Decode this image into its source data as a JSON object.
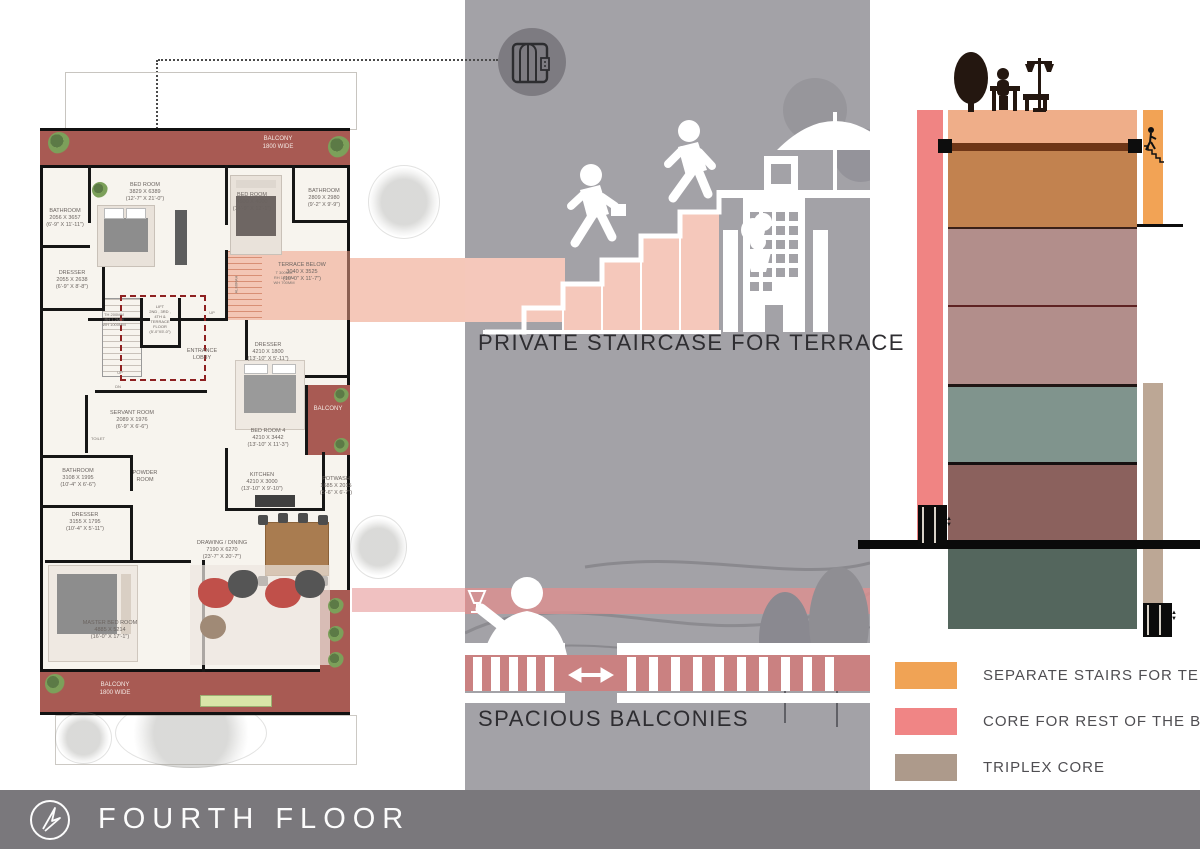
{
  "footer": {
    "title": "FOURTH FLOOR",
    "logo": "compass-arrow-icon"
  },
  "captions": {
    "staircase": "PRIVATE STAIRCASE FOR TERRACE",
    "balconies": "SPACIOUS BALCONIES"
  },
  "legend": {
    "items": [
      {
        "label": "SEPARATE STAIRS FOR TERRACE",
        "color": "#f0a355"
      },
      {
        "label": "CORE FOR REST OF THE BUILDING",
        "color": "#f08585"
      },
      {
        "label": "TRIPLEX CORE",
        "color": "#ad9a8b"
      }
    ]
  },
  "section": {
    "floors": [
      {
        "color": "#efae89",
        "h": 33
      },
      {
        "color": "#6f3617",
        "h": 8
      },
      {
        "color": "#c2824f",
        "h": 76
      },
      {
        "color": "#3a2018",
        "h": 2
      },
      {
        "color": "#b28e8b",
        "h": 76
      },
      {
        "color": "#5e2222",
        "h": 2
      },
      {
        "color": "#b28e8b",
        "h": 77
      },
      {
        "color": "#201614",
        "h": 3
      },
      {
        "color": "#80948d",
        "h": 75
      },
      {
        "color": "#161010",
        "h": 3
      },
      {
        "color": "#8b615d",
        "h": 76
      }
    ],
    "core_color": "#f08483",
    "stair_color": "#f2a355",
    "triplex_color": "#bca795"
  },
  "plan": {
    "rooms": [
      {
        "lines": [
          "BED ROOM",
          "3829 X 6389",
          "(12'-7\" X 21'-0\")"
        ],
        "x": 105,
        "y": 112
      },
      {
        "lines": [
          "BED ROOM",
          "4500 X 4000",
          "(14'-9\" X 12'-1\")"
        ],
        "x": 212,
        "y": 122
      },
      {
        "lines": [
          "BATHROOM",
          "2809 X 2980",
          "(9'-2\" X 9'-9\")"
        ],
        "x": 284,
        "y": 118
      },
      {
        "lines": [
          "BATHROOM",
          "2056 X 3657",
          "(6'-9\" X 11'-11\")"
        ],
        "x": 25,
        "y": 138
      },
      {
        "lines": [
          "DRESSER",
          "2055 X 2638",
          "(6'-9\" X 8'-8\")"
        ],
        "x": 32,
        "y": 200
      },
      {
        "lines": [
          "TERRACE BELOW",
          "3040 X 3525",
          "(10'-0\" X 11'-7\")"
        ],
        "x": 262,
        "y": 192
      },
      {
        "lines": [
          "LIFT",
          "2ND , 3RD ,",
          "4TH &",
          "TERRACE",
          "FLOOR",
          "(5'-0\"X5'-0\")"
        ],
        "x": 120,
        "y": 234,
        "size": 4
      },
      {
        "lines": [
          "ENTRANCE",
          "LOBBY"
        ],
        "x": 162,
        "y": 278
      },
      {
        "lines": [
          "DRESSER",
          "4210 X 1800",
          "(13'-10\" X 5'-11\")"
        ],
        "x": 228,
        "y": 272
      },
      {
        "lines": [
          "BED ROOM 4",
          "4210 X 3442",
          "(13'-10\" X 11'-3\")"
        ],
        "x": 228,
        "y": 358
      },
      {
        "lines": [
          "SERVANT ROOM",
          "2089 X 1976",
          "(6'-9\" X 6'-6\")"
        ],
        "x": 92,
        "y": 340
      },
      {
        "lines": [
          "BATHROOM",
          "3108 X 1995",
          "(10'-4\" X 6'-6\")"
        ],
        "x": 38,
        "y": 398
      },
      {
        "lines": [
          "POWDER",
          "ROOM"
        ],
        "x": 105,
        "y": 400
      },
      {
        "lines": [
          "DRESSER",
          "3155 X 1795",
          "(10'-4\" X 5'-11\")"
        ],
        "x": 45,
        "y": 442
      },
      {
        "lines": [
          "KITCHEN",
          "4210 X 3000",
          "(13'-10\" X 9'-10\")"
        ],
        "x": 222,
        "y": 402
      },
      {
        "lines": [
          "POTWASH",
          "1685 X 2015",
          "(5'-6\" X 6'-7\")"
        ],
        "x": 296,
        "y": 406
      },
      {
        "lines": [
          "DRAWING / DINING",
          "7190 X 6270",
          "(23'-7\" X 20'-7\")"
        ],
        "x": 182,
        "y": 470
      },
      {
        "lines": [
          "MASTER BED ROOM",
          "4885 X 5214",
          "(16'-0\" X 17'-1\")"
        ],
        "x": 70,
        "y": 550
      }
    ],
    "white_labels": [
      {
        "lines": [
          "BALCONY",
          "1800 WIDE"
        ],
        "x": 238,
        "y": 66
      },
      {
        "lines": [
          "BALCONY",
          "1800 WIDE"
        ],
        "x": 75,
        "y": 612
      },
      {
        "lines": [
          "BALCONY"
        ],
        "x": 288,
        "y": 336
      }
    ],
    "small_labels": [
      {
        "lines": [
          "TOILET"
        ],
        "x": 58,
        "y": 366
      },
      {
        "lines": [
          "UP"
        ],
        "x": 80,
        "y": 300
      },
      {
        "lines": [
          "DN"
        ],
        "x": 78,
        "y": 314
      },
      {
        "lines": [
          "UP"
        ],
        "x": 172,
        "y": 240
      },
      {
        "lines": [
          "T 300MM",
          "RH 150MM",
          "WH 700MM"
        ],
        "x": 244,
        "y": 200
      },
      {
        "lines": [
          "TH 200MM",
          "RH 1.2MM",
          "WH 1000MM"
        ],
        "x": 74,
        "y": 242
      },
      {
        "lines": [
          "ALMIRAH"
        ],
        "x": 196,
        "y": 212,
        "vert": true
      }
    ]
  },
  "middle_panel": {
    "lift_bubble": "elevator-icon"
  }
}
